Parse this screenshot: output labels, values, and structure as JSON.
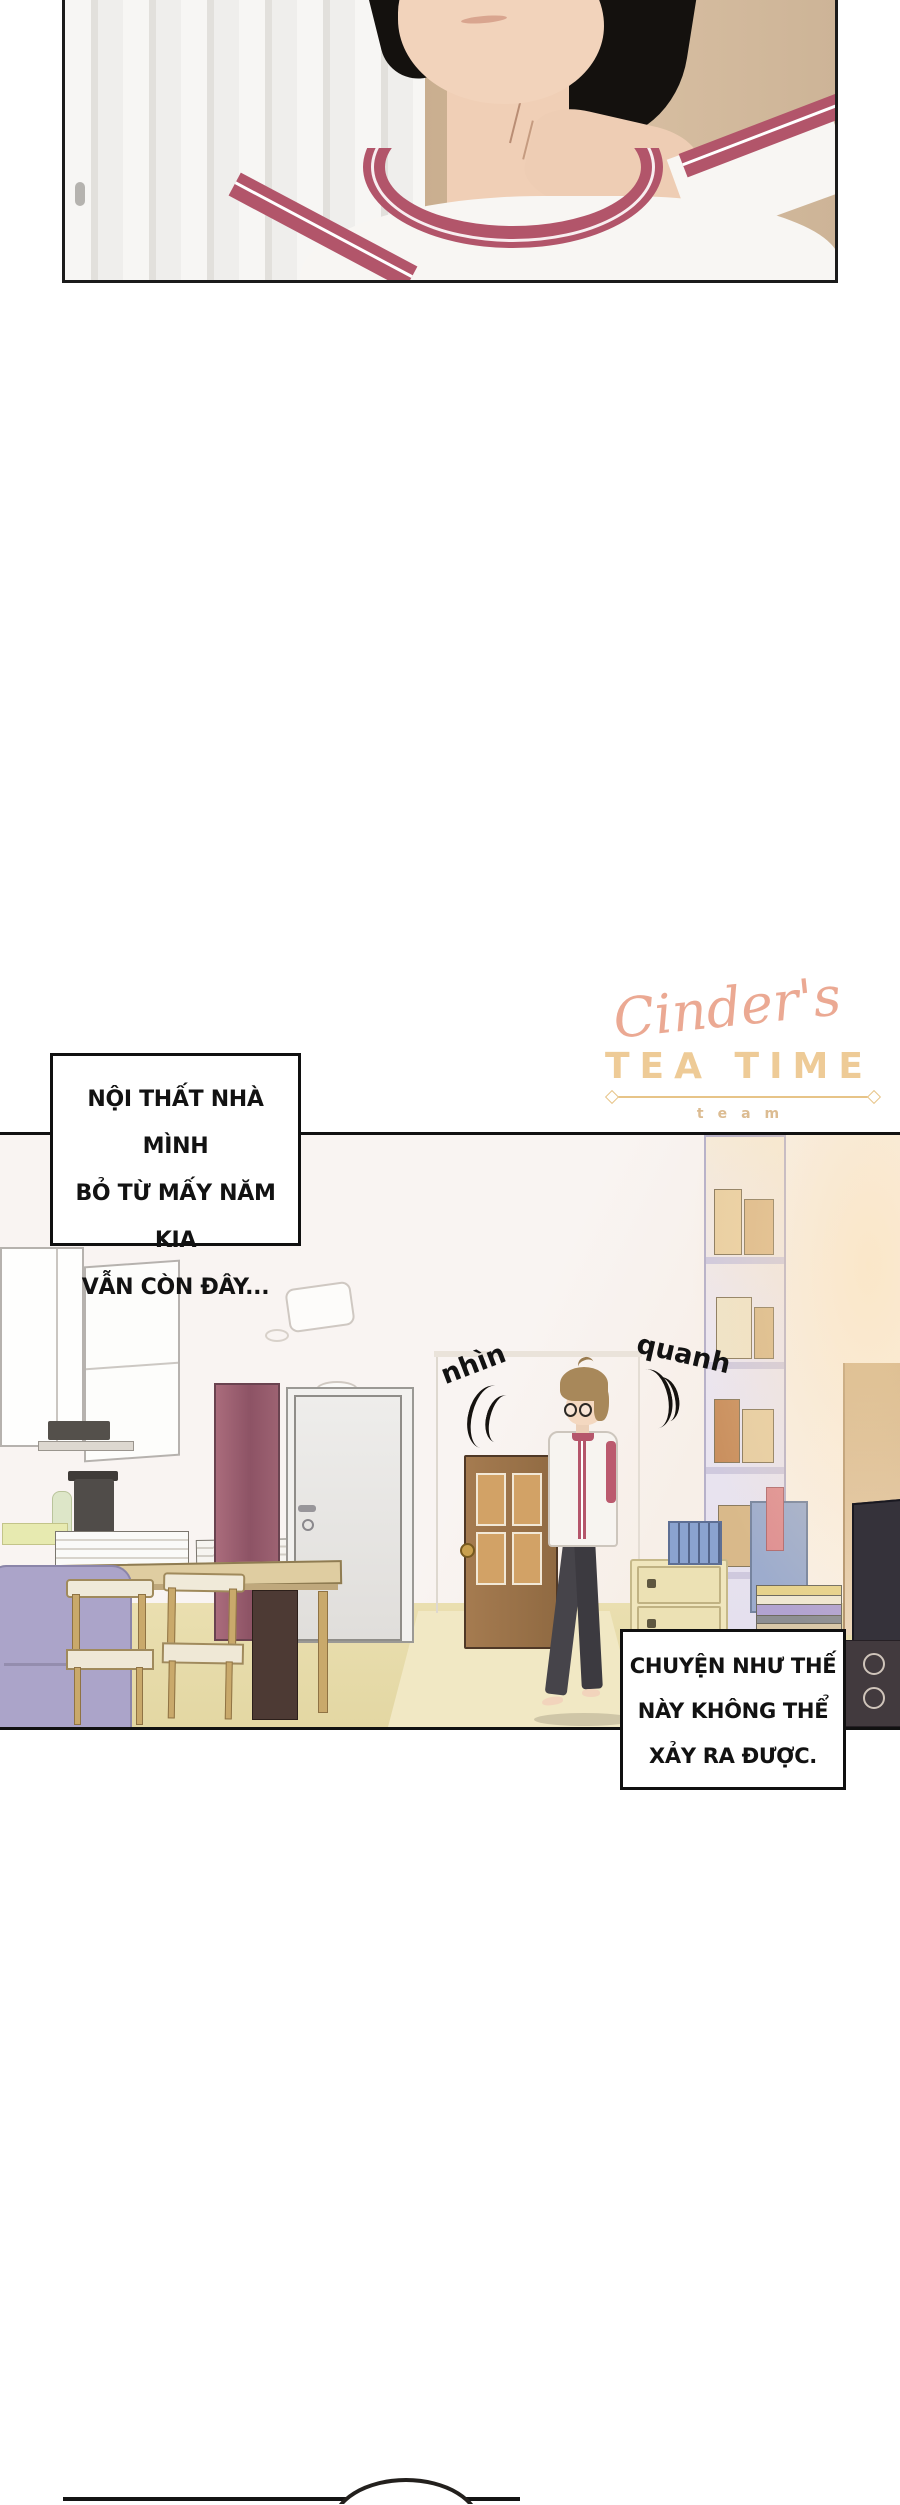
{
  "page": {
    "width": 900,
    "height": 2505,
    "background": "#ffffff",
    "type": "manhwa-comic-page"
  },
  "watermark": {
    "script": "Cinder's",
    "title": "TEA TIME",
    "subtitle": "team",
    "colors": {
      "script": "#eba993",
      "title": "#eecb97",
      "divider": "#e7c488",
      "subtitle": "#dcbc92"
    }
  },
  "narration_box_1": {
    "lines": [
      "NỘI THẤT NHÀ MÌNH",
      "BỎ TỪ MẤY NĂM KIA",
      "VẪN CÒN ĐÂY..."
    ]
  },
  "sfx": {
    "look": "nhìn",
    "around": "quanh"
  },
  "narration_box_2": {
    "lines": [
      "CHUYỆN NHƯ THẾ",
      "NÀY KHÔNG THỂ",
      "XẢY RA ĐƯỢC."
    ]
  },
  "palette": {
    "panel_border": "#1b1b1b",
    "shirt_trim_red": "#b2556a",
    "skin": "#f2d3bb",
    "hair_black": "#14110e",
    "wall_beige": "#d3b896",
    "room_wall": "#f9f4f2",
    "floor_tan": "#e8dcab",
    "sofa_lavender": "#aba4c9",
    "wood_door_brown": "#9b7147",
    "door_pane_amber": "#d2a266",
    "maroon_cabinet": "#8d5365",
    "drawer_cream": "#f0e6bd",
    "bin_blue": "#8ba3cf",
    "person_hair_brown": "#a8885a",
    "pants_gray": "#46444a"
  }
}
